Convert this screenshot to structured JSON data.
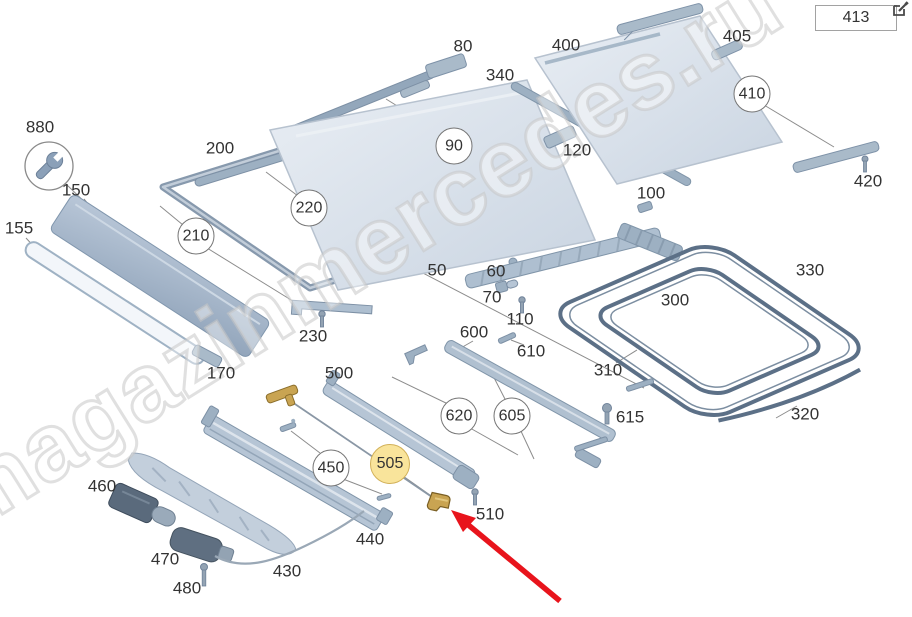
{
  "header": {
    "figure_ref": "413"
  },
  "watermark": {
    "text": "magazinmercedes.ru"
  },
  "icons": {
    "edit": "edit-icon",
    "wrench": "wrench-icon"
  },
  "colors": {
    "highlight_fill": "#F9E49B",
    "highlight_border": "#D2B159",
    "arrow_red": "#E8141C",
    "part_steel": "#AEBFD0",
    "seal_dark": "#5C7087",
    "gold_part": "#C9A452",
    "label_text": "#333333"
  },
  "diagram": {
    "highlighted_part": "505",
    "labels": {
      "50": "50",
      "60": "60",
      "70": "70",
      "80": "80",
      "90": "90",
      "100": "100",
      "110": "110",
      "120": "120",
      "150": "150",
      "155": "155",
      "170": "170",
      "200": "200",
      "210": "210",
      "220": "220",
      "230": "230",
      "300": "300",
      "310": "310",
      "320": "320",
      "330": "330",
      "340": "340",
      "400": "400",
      "405": "405",
      "410": "410",
      "413": "413",
      "420": "420",
      "430": "430",
      "440": "440",
      "450": "450",
      "460": "460",
      "470": "470",
      "480": "480",
      "500": "500",
      "505": "505",
      "510": "510",
      "600": "600",
      "605": "605",
      "610": "610",
      "615": "615",
      "620": "620",
      "880": "880"
    }
  }
}
